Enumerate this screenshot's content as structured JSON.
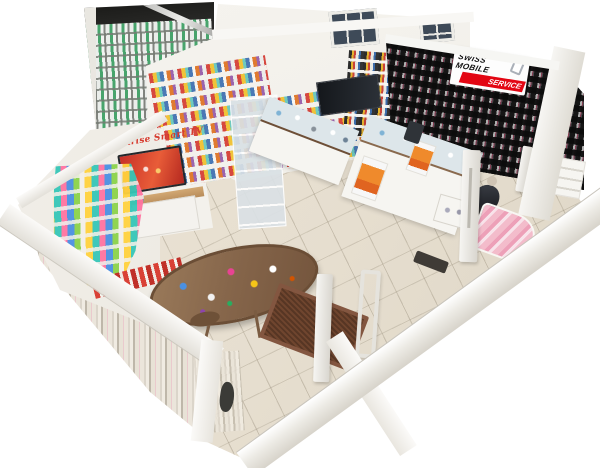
{
  "scene": {
    "type": "3d-dollhouse-store-scan",
    "store": "Mobile phone shop interior, cutaway overhead view",
    "signs": {
      "swiss_mobile": {
        "line1": "SWISS MOBILE",
        "line2": "SERVICE"
      },
      "sunrise": {
        "label": "Sunrise Smart TV"
      }
    },
    "colors": {
      "background": "#ffffff",
      "floor": "#e8e0d1",
      "walls": "#f3f1ec",
      "dark_product_wall": "#181818",
      "swiss_sign_red": "#e30613",
      "sunrise_text_red": "#d63a2e",
      "tv_screen_red": "#cf3a28",
      "table_wood": "#8a6a4e",
      "doormat_brown": "#6f452e",
      "backroom_accent_green": "#2e9b5a"
    }
  }
}
